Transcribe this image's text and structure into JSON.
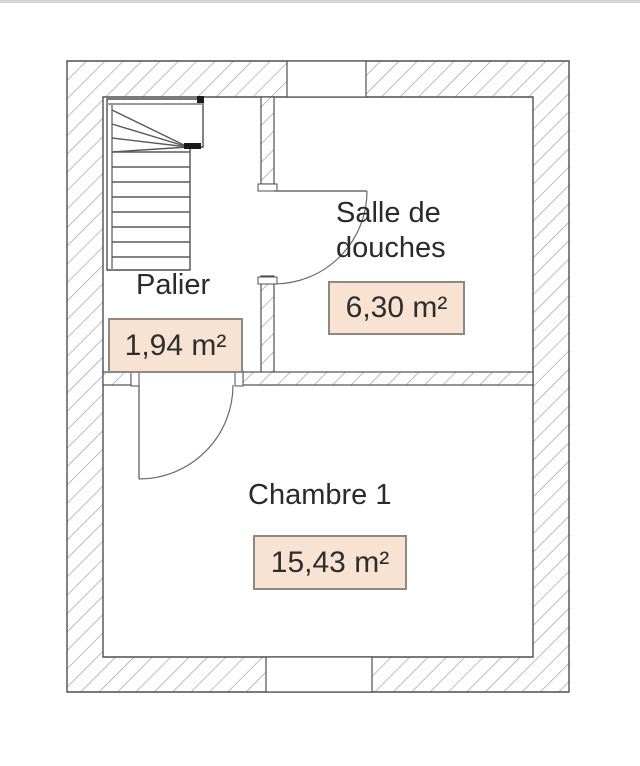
{
  "page": {
    "type": "floor-plan",
    "background": "#ffffff",
    "top_edge_color": "#d6d6d6"
  },
  "rooms": {
    "palier": {
      "name": "Palier",
      "area": "1,94 m²"
    },
    "salle_de_douches": {
      "name": "Salle de douches",
      "area": "6,30 m²"
    },
    "chambre_1": {
      "name": "Chambre 1",
      "area": "15,43 m²"
    }
  },
  "style": {
    "area_box_bg": "#f8e3d2",
    "area_box_border": "#8f8882",
    "wall_line": "#4f4f4f",
    "hatch_line": "#9a9a9a",
    "text_color": "#2a2a2a"
  }
}
